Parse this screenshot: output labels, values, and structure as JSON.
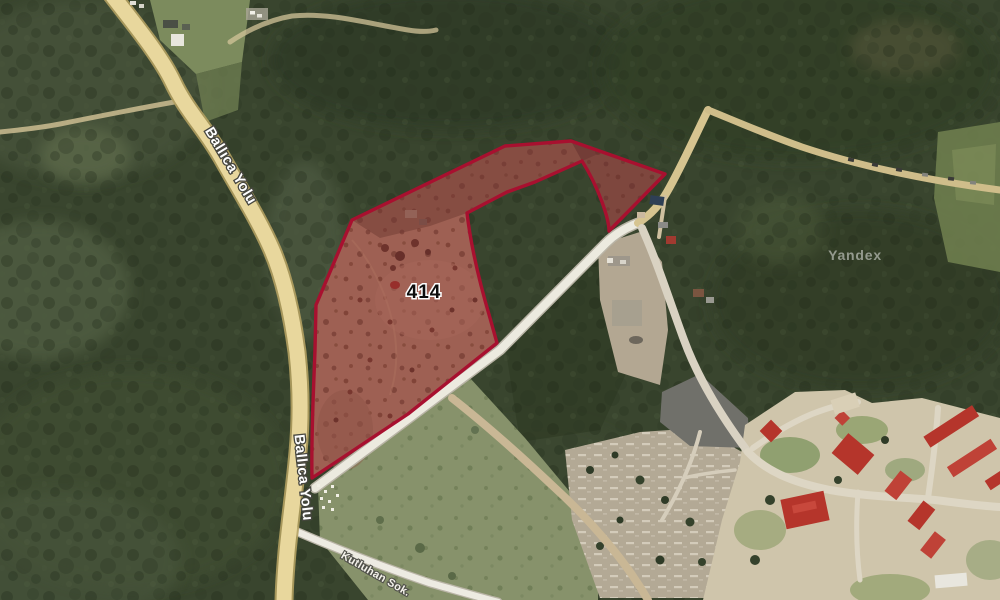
{
  "app": {
    "watermark": "Yandex",
    "view": "satellite"
  },
  "parcel": {
    "number": "414",
    "outline_color": "#a8102f",
    "fill_color": "rgba(168,16,47,0.24)"
  },
  "roads": {
    "main_top_label": "Ballıca Yolu",
    "main_bottom_label": "Ballıca Yolu",
    "street_label": "Kutluhan Sok."
  },
  "colors": {
    "forest": "#39452e",
    "field": "#9b7a5f",
    "main_road": "#e8d79d",
    "secondary_road": "#eceadf",
    "campus_ground": "#d3c9ae",
    "red_roof": "#b5352b"
  }
}
